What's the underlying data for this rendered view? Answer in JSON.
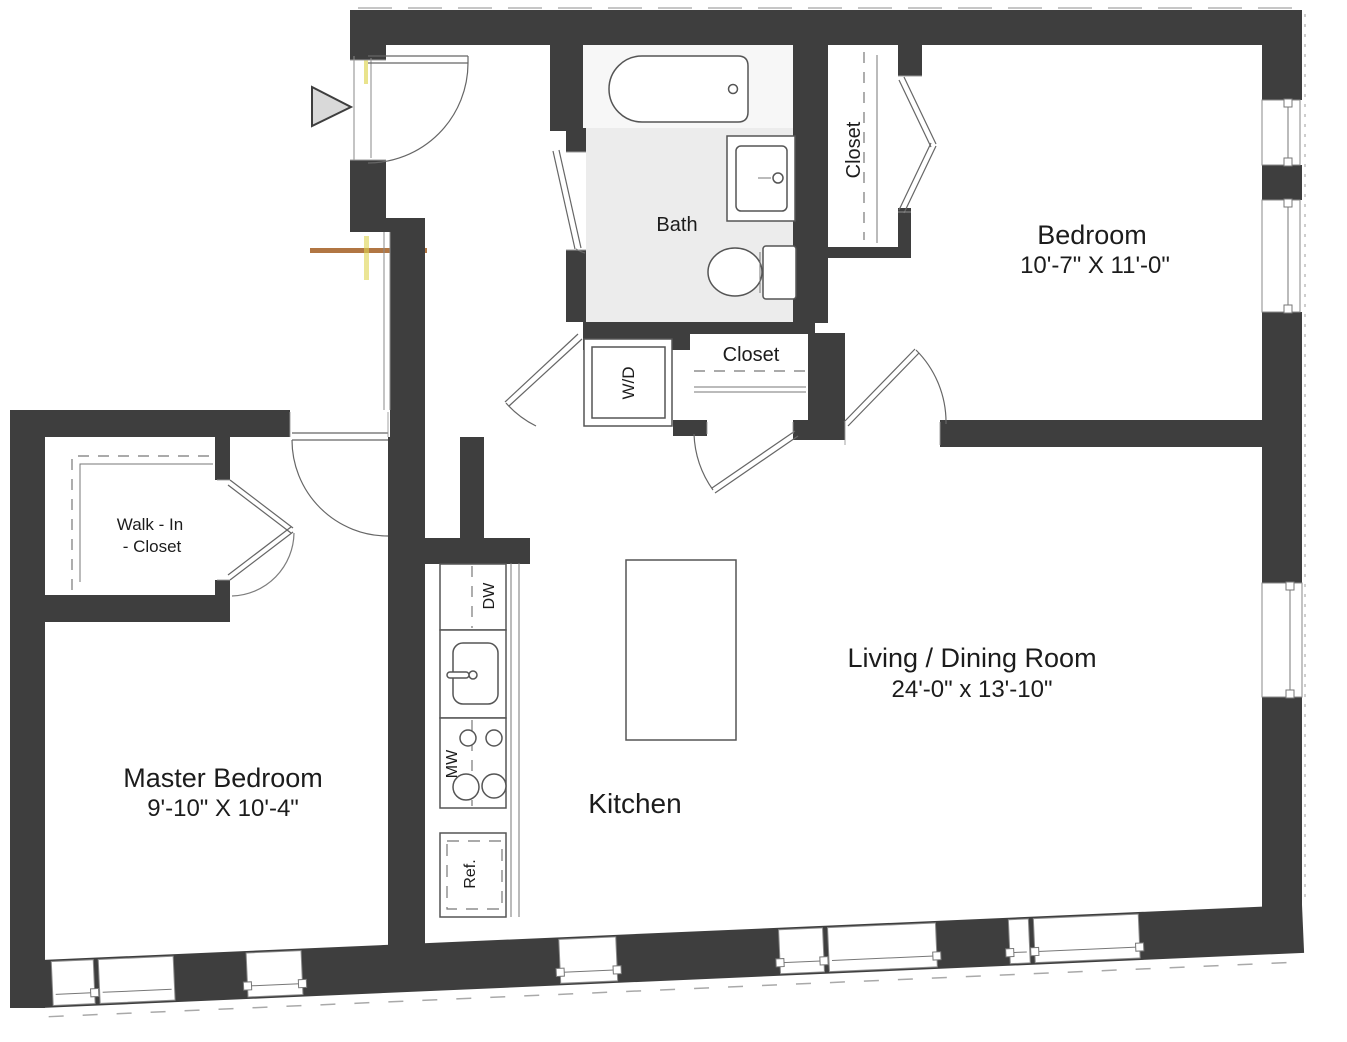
{
  "plan": {
    "title": "Two Bedroom Apartment Floor Plan",
    "rooms": {
      "bedroom": {
        "name": "Bedroom",
        "dims": "10'-7\" X 11'-0\""
      },
      "living_dining": {
        "name": "Living / Dining Room",
        "dims": "24'-0\" x 13'-10\""
      },
      "master_bedroom": {
        "name": "Master Bedroom",
        "dims": "9'-10\" X 10'-4\""
      },
      "kitchen": {
        "name": "Kitchen"
      },
      "bath": {
        "name": "Bath"
      },
      "hall_closet": {
        "name": "Closet"
      },
      "bedroom_closet": {
        "name": "Closet"
      },
      "walk_in_closet": {
        "line1": "Walk - In",
        "line2": "- Closet"
      }
    },
    "appliances": {
      "washer_dryer": "W/D",
      "dishwasher": "DW",
      "microwave_range": "MW",
      "refrigerator": "Ref."
    },
    "colors": {
      "wall": "#3e3e3e",
      "paper": "#ffffff",
      "bath_floor": "#ececec",
      "line": "#666666",
      "entry_arrow_fill": "#d9d9d9",
      "scan_artifact_orange": "#a9672f",
      "scan_artifact_yellow": "#ddd44e"
    }
  }
}
